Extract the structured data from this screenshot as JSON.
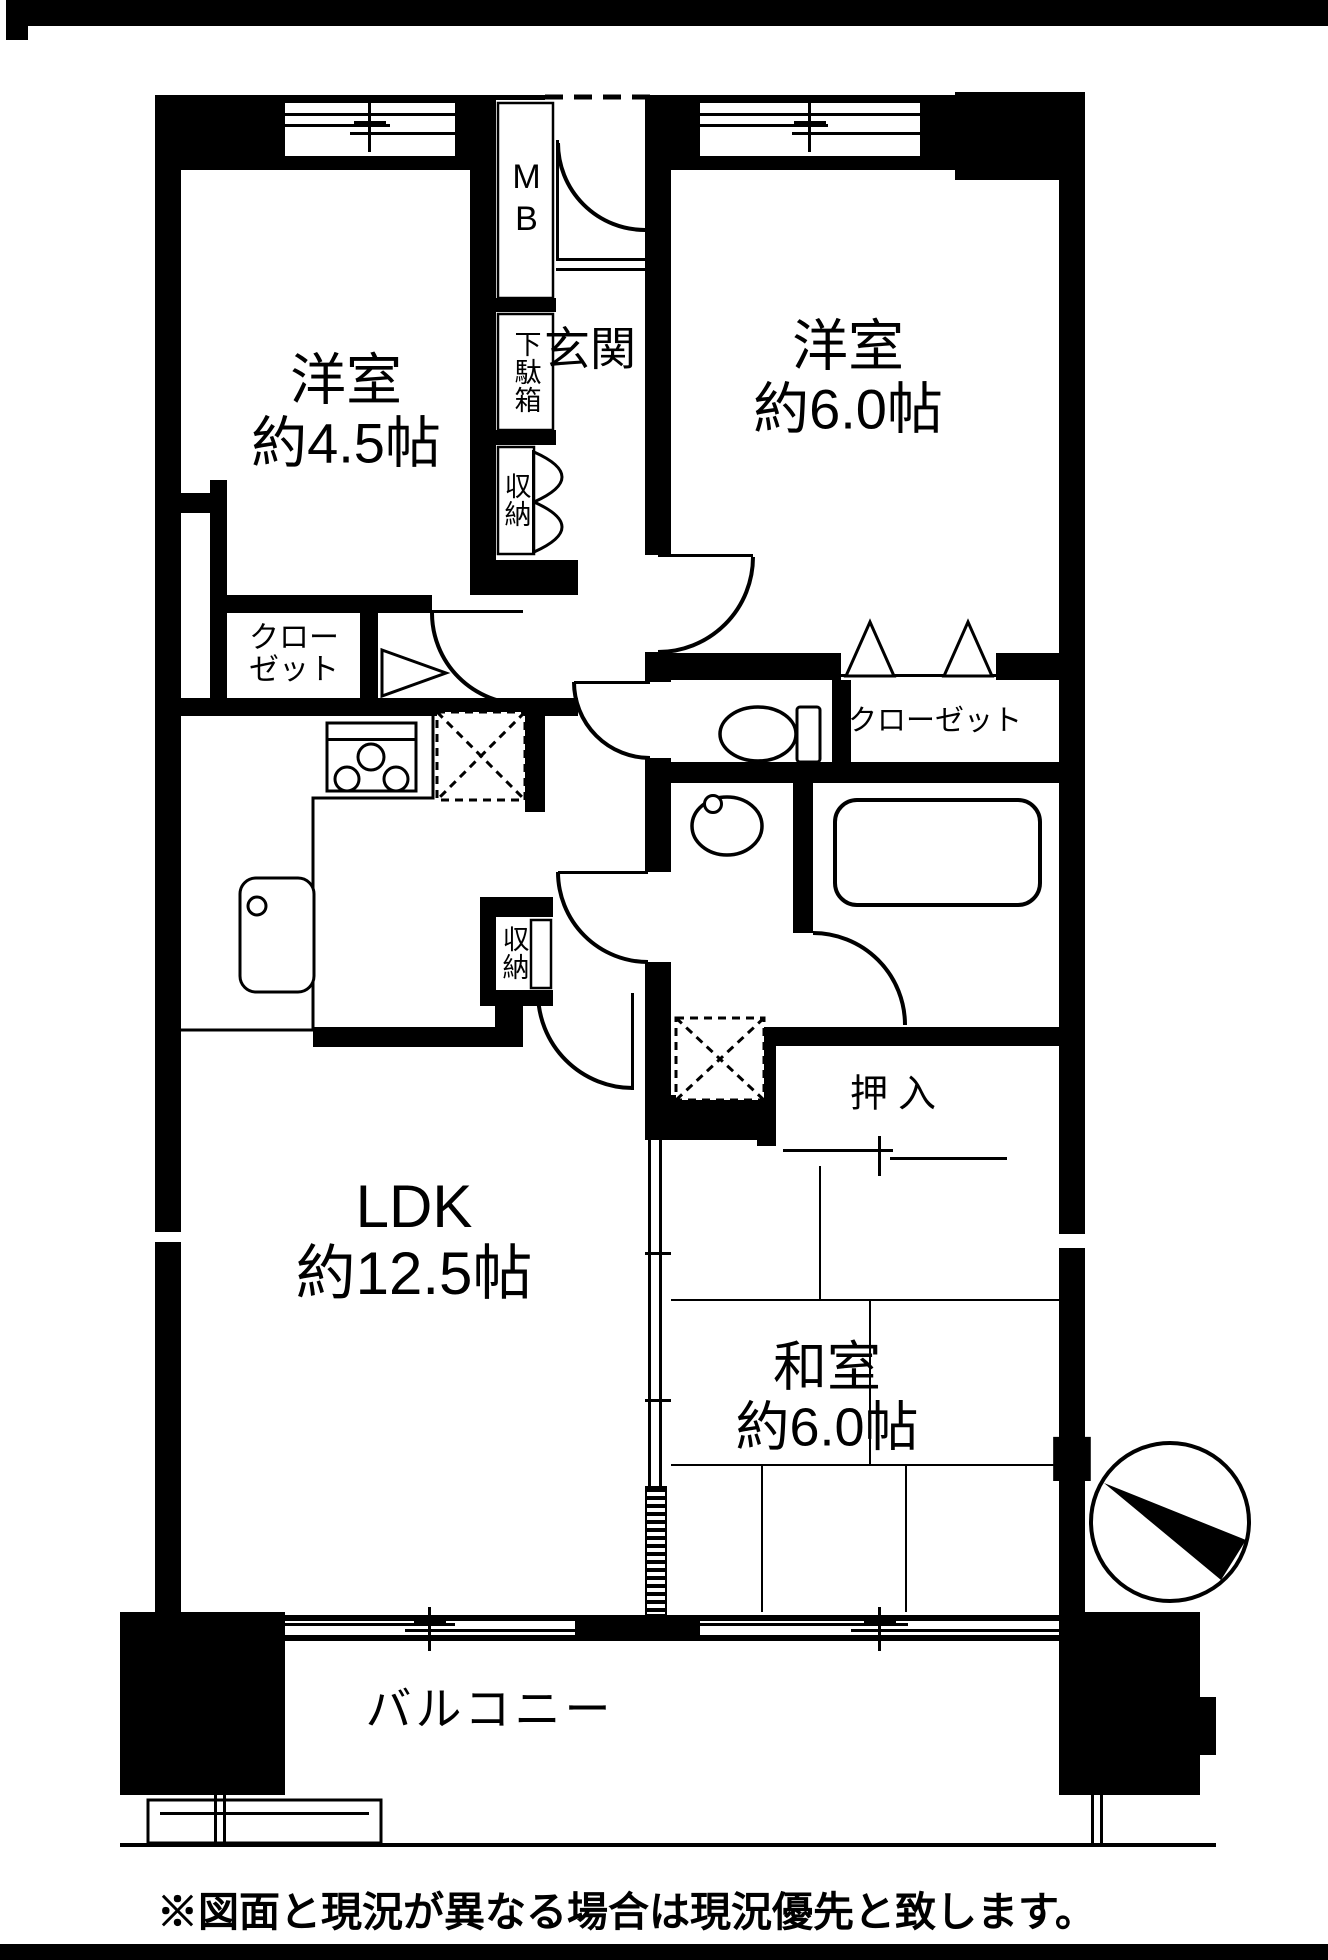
{
  "rooms": {
    "western_small": {
      "name": "洋室",
      "size": "約4.5帖"
    },
    "western_large": {
      "name": "洋室",
      "size": "約6.0帖"
    },
    "ldk": {
      "name": "LDK",
      "size": "約12.5帖"
    },
    "japanese": {
      "name": "和室",
      "size": "約6.0帖"
    },
    "entrance": {
      "name": "玄関"
    },
    "balcony": {
      "name": "バルコニー"
    }
  },
  "fixtures": {
    "meter_box": "MB",
    "shoe_cabinet": "下駄箱",
    "hall_storage": "収納",
    "kitchen_storage": "収納",
    "closet_small_l1": "クロー",
    "closet_small_l2": "ゼット",
    "closet_large": "クローゼット",
    "oshiire": "押入"
  },
  "compass": {
    "north_label": "N"
  },
  "footer": {
    "note": "※図面と現況が異なる場合は現況優先と致します。"
  },
  "colors": {
    "ink": "#000000",
    "paper": "#ffffff"
  }
}
